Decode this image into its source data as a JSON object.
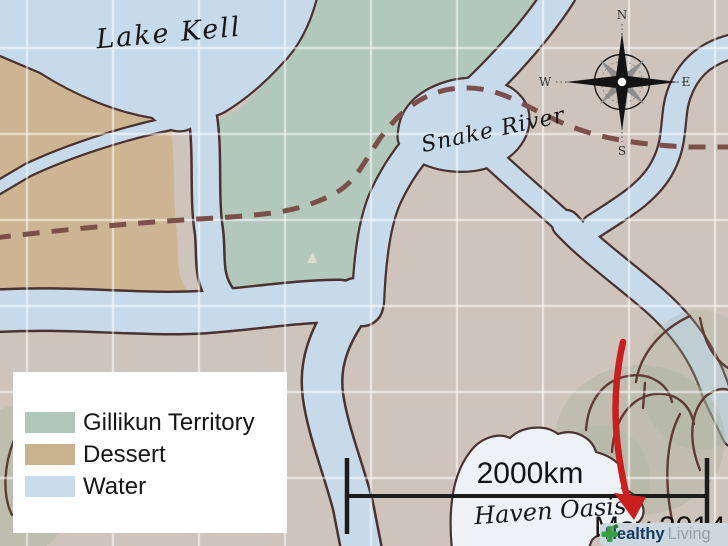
{
  "map": {
    "labels": {
      "lake": "Lake Kell",
      "river": "Snake River",
      "oasis": "Haven Oasis",
      "date": "May 2014"
    },
    "compass": {
      "north": "N",
      "east": "E",
      "south": "S",
      "west": "W"
    },
    "scale": {
      "distance_label": "2000km"
    },
    "legend": {
      "items": [
        {
          "label": "Gillikun Territory",
          "color": "#b0c6ba"
        },
        {
          "label": "Dessert",
          "color": "#c8b28d"
        },
        {
          "label": "Water",
          "color": "#c9dcec"
        }
      ]
    },
    "colors": {
      "land": "#cec4bc",
      "territory": "#b1c8ba",
      "dessert": "#cdb493",
      "water": "#c7daea",
      "outline": "#4a3230",
      "trail": "#7d4f4a",
      "oasis_fill": "#eef2f5",
      "vegetation": "#a9b49c",
      "grid": "rgba(255,255,255,0.5)",
      "scale_bar": "#1c1c1c",
      "arrow": "#cb1f1f",
      "logo_bg": "#ccd7df",
      "logo_green": "#35a13f"
    },
    "watermark": {
      "brand_bold": "Healthy",
      "brand_light": "Living"
    }
  }
}
